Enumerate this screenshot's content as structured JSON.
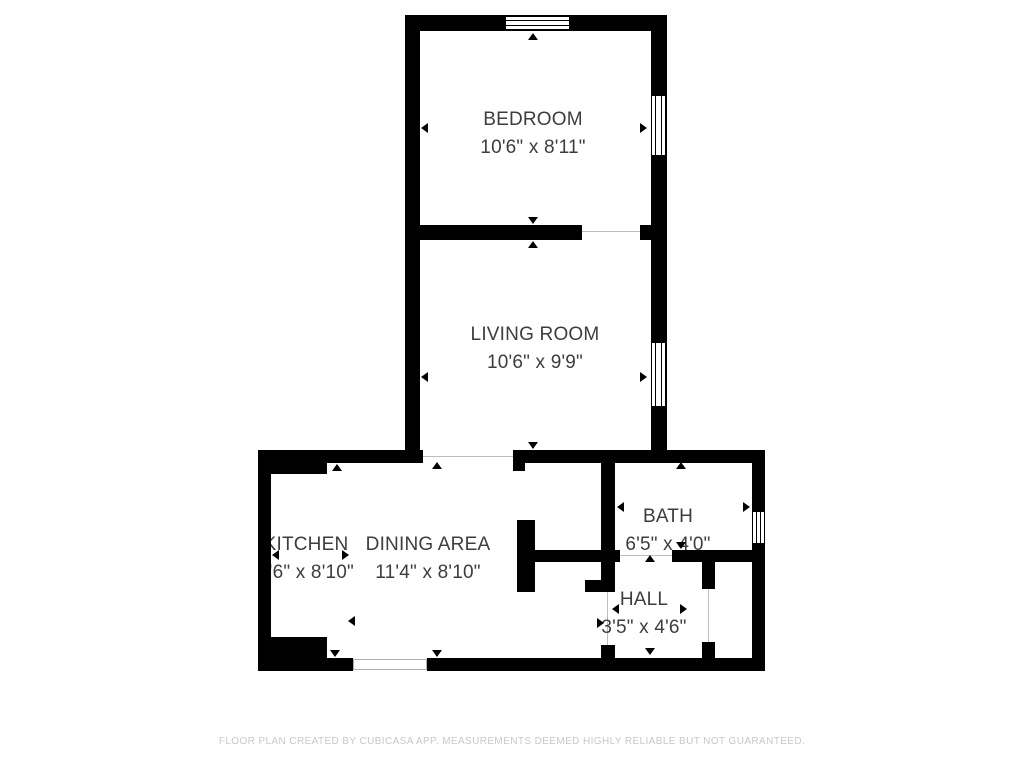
{
  "colors": {
    "wall": "#000000",
    "label": "#3d3d3d",
    "footer": "#c8c8c8",
    "background": "#ffffff",
    "opening": "#bdbdbd"
  },
  "rooms": {
    "bedroom": {
      "name": "BEDROOM",
      "dims": "10'6\" x 8'11\""
    },
    "living": {
      "name": "LIVING ROOM",
      "dims": "10'6\" x 9'9\""
    },
    "kitchen": {
      "name": "KITCHEN",
      "dims": "3'6\" x 8'10\""
    },
    "dining": {
      "name": "DINING AREA",
      "dims": "11'4\" x 8'10\""
    },
    "bath": {
      "name": "BATH",
      "dims": "6'5\" x 4'0\""
    },
    "hall": {
      "name": "HALL",
      "dims": "3'5\" x 4'6\""
    }
  },
  "footer": {
    "disclaimer": "FLOOR PLAN CREATED BY CUBICASA APP. MEASUREMENTS DEEMED HIGHLY RELIABLE BUT NOT GUARANTEED."
  }
}
